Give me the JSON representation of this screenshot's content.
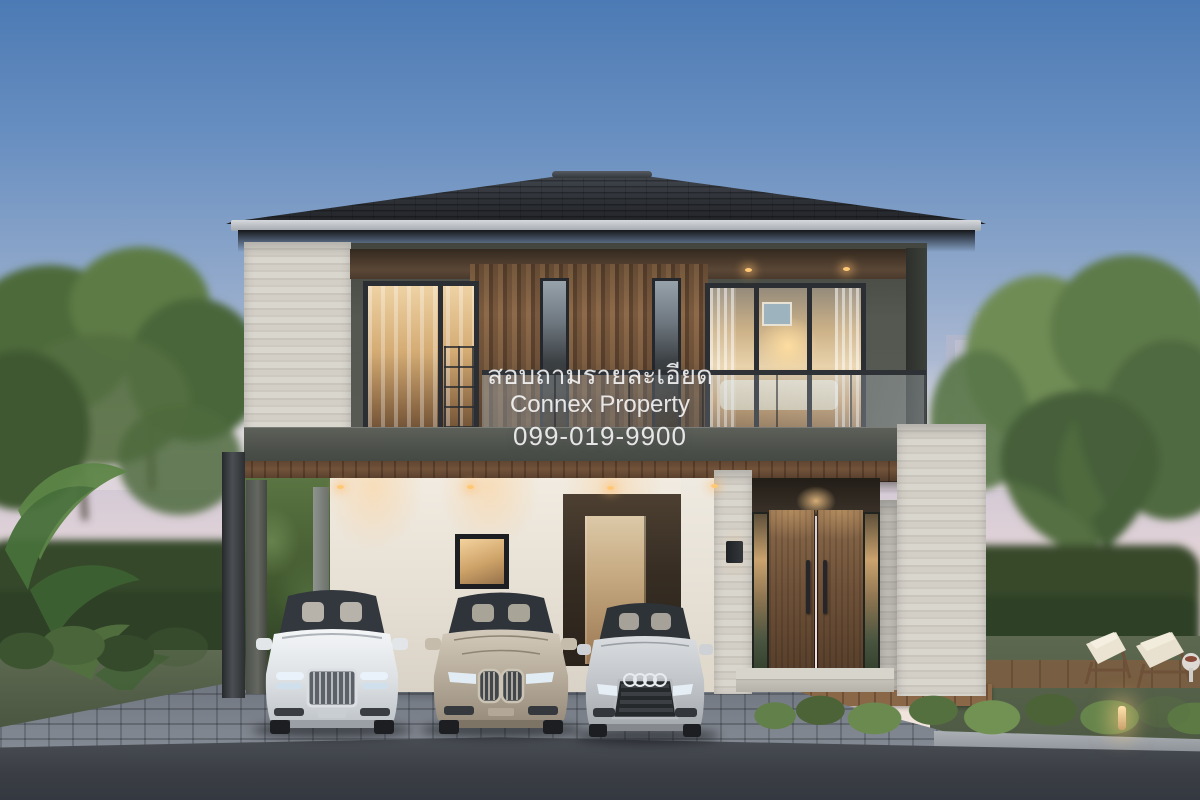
{
  "watermark": {
    "line1": "สอบถามรายละเอียด",
    "line2": "Connex Property",
    "line3": "099-019-9900"
  },
  "scene": {
    "type": "3D architectural rendering, dusk exterior",
    "subject": "Modern two-storey house with carport, glass balcony and garden",
    "cars": [
      {
        "label": "white luxury sedan"
      },
      {
        "label": "champagne luxury sedan"
      },
      {
        "label": "silver sedan with four-ring badge"
      }
    ]
  },
  "palette": {
    "sky_top": "#4C7AB4",
    "sky_horizon": "#F2E8E0",
    "roof": "#2B2E33",
    "upper_wall": "#565A52",
    "travertine": "#D6D3CB",
    "wood_screen": "#7C5C3F",
    "entry_door": "#6E5138",
    "white_wall": "#ECE8E0",
    "warm_glass": "#E9BE82",
    "foliage": "#55713F",
    "lawn": "#5A664E",
    "pavers": "#7A8089",
    "asphalt": "#42464C",
    "watermark_text": "#FFFFFF"
  }
}
